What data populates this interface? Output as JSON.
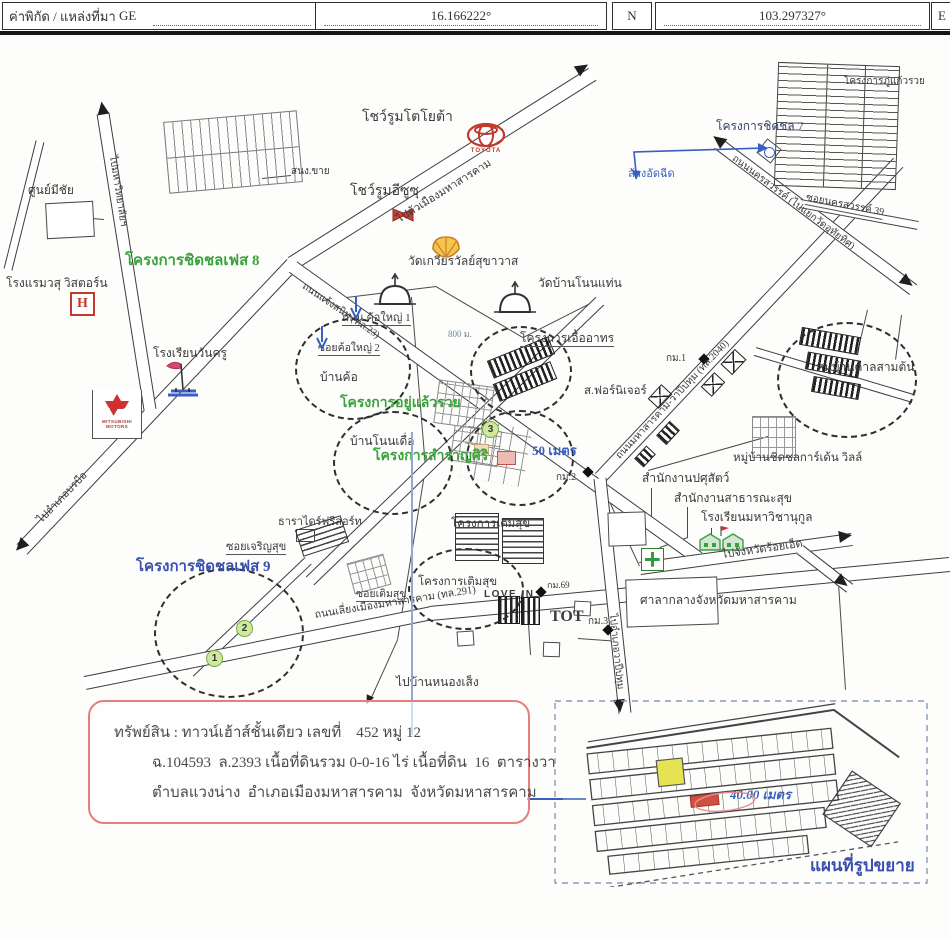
{
  "header": {
    "source_label": "ค่าพิกัด / แหล่งที่มา",
    "source_value": "GE",
    "latitude": "16.166222°",
    "lat_hemisphere": "N",
    "longitude": "103.297327°",
    "lng_hemisphere": "E"
  },
  "map": {
    "labels": {
      "toyota_showroom": "โชว์รูมโตโยต้า",
      "toyota_logo": "TOYOTA",
      "isuzu_showroom": "โชว์รูมอีซูซุ",
      "sales_office": "สนง.ขาย",
      "meechai_center": "ศูนย์มีชัย",
      "phase8": "โครงการชิดชลเฟส 8",
      "hotel_wistorn": "โรงแรมวสุ วิสตอร์น",
      "hospital": "H",
      "wankru_school": "โรงเรียนวันครู",
      "mitsubishi": "MITSUBISHI MOTORS",
      "to_university": "ไปมหาวิทยาลัยฯ",
      "to_borabue": "ไปอำเภอบรบือ",
      "chaengsanit_rd": "ถนนแจ้งสนิท (ทล.23)",
      "to_city": "ไปตัวเมืองมหาสารคาม",
      "wat_kwian": "วัดเกวียรวัลย์สุขาวาส",
      "wat_nonthaen": "วัดบ้านโนนแท่น",
      "kho_yai_rd": "ถนน ค้อใหญ่ 1",
      "soi_kho_yai2": "ซอยค้อใหญ่ 2",
      "ban_kho": "บ้านค้อ",
      "dist_800": "800 ม.",
      "uea_athon": "โครงการเอื้ออาทร",
      "furniture": "ส.ฟอร์นิเจอร์",
      "km1": "กม.1",
      "km2": "กม.2",
      "km3": "กม.3",
      "km69": "กม.69",
      "ban_kan_samton": "หมู่บ้านคาลสามต้น",
      "yu_laew_ruay": "โครงการอยู่แล้วรวย",
      "ban_non_duea": "บ้านโนนเดื่อ",
      "samran_siri": "โครงการสำราญศิริ",
      "meters50": "50 เมตร",
      "pusat_office": "สำนักงานปศุสัตว์",
      "health_office": "สำนักงานสาธารณะสุข",
      "mahawicha_school": "โรงเรียนมหาวิชานุกูล",
      "garden_ville": "หมู่บ้านชิดชลการ์เด้น วิลล์",
      "to_roiet": "ไปจังหวัดร้อยเอ็ด",
      "city_hall": "ศาลากลางจังหวัดมหาสารคาม",
      "to_wapi": "ไปอำเภอวาปีปทุม",
      "rd2040": "ถนนมหาสารคาม-วาปีปทุม (ทล.2040)",
      "nakhon_rd": "ถนนนครสวรรค์ (ไปแยกวัดอุทัยทิศ)",
      "soi_nakhon39": "ซอยนครสวรรค์ 39",
      "tot": "TOT",
      "love_in": "LOVE IN",
      "to_nong_seng": "ไปบ้านหนองเส็ง",
      "bypass_rd": "ถนนเลี่ยงเมืองมหาสารคาม (ทล.291)",
      "tara_resort": "ธาราไดร์ฟรีสอร์ท",
      "term_suk_a": "โครงการเติมสุข",
      "term_suk_b": "โครงการเติมสุข",
      "soi_term_suk": "ซอยเติมสุข",
      "soi_charoen_suk": "ซอยเจริญสุข",
      "phase9": "โครงการชิดชลเฟส 9",
      "phase7": "โครงการชิดชล 7",
      "phu_kaew_ruay": "โครงการภู่แก้วรวย",
      "car_wash": "ล้างอัดฉีด",
      "num1": "1",
      "num2": "2",
      "num3": "3"
    }
  },
  "property_box": {
    "line1": "ทรัพย์สิน : ทาวน์เฮ้าส์ชั้นเดียว เลขที่    452 หมู่ 12",
    "line2": "ฉ.104593  ล.2393 เนื้อที่ดินรวม 0-0-16 ไร่ เนื้อที่ดิน  16  ตารางวา",
    "line3": "ตำบลแวงน่าง  อำเภอเมืองมหาสารคาม  จังหวัดมหาสารคาม"
  },
  "inset": {
    "scale_note": "40.00 เมตร",
    "title": "แผนที่รูปขยาย"
  },
  "colors": {
    "project_green": "#3aa23a",
    "annotation_blue": "#3a5fc0",
    "phase9_blue": "#3a4fae",
    "brand_red": "#c0392b"
  }
}
